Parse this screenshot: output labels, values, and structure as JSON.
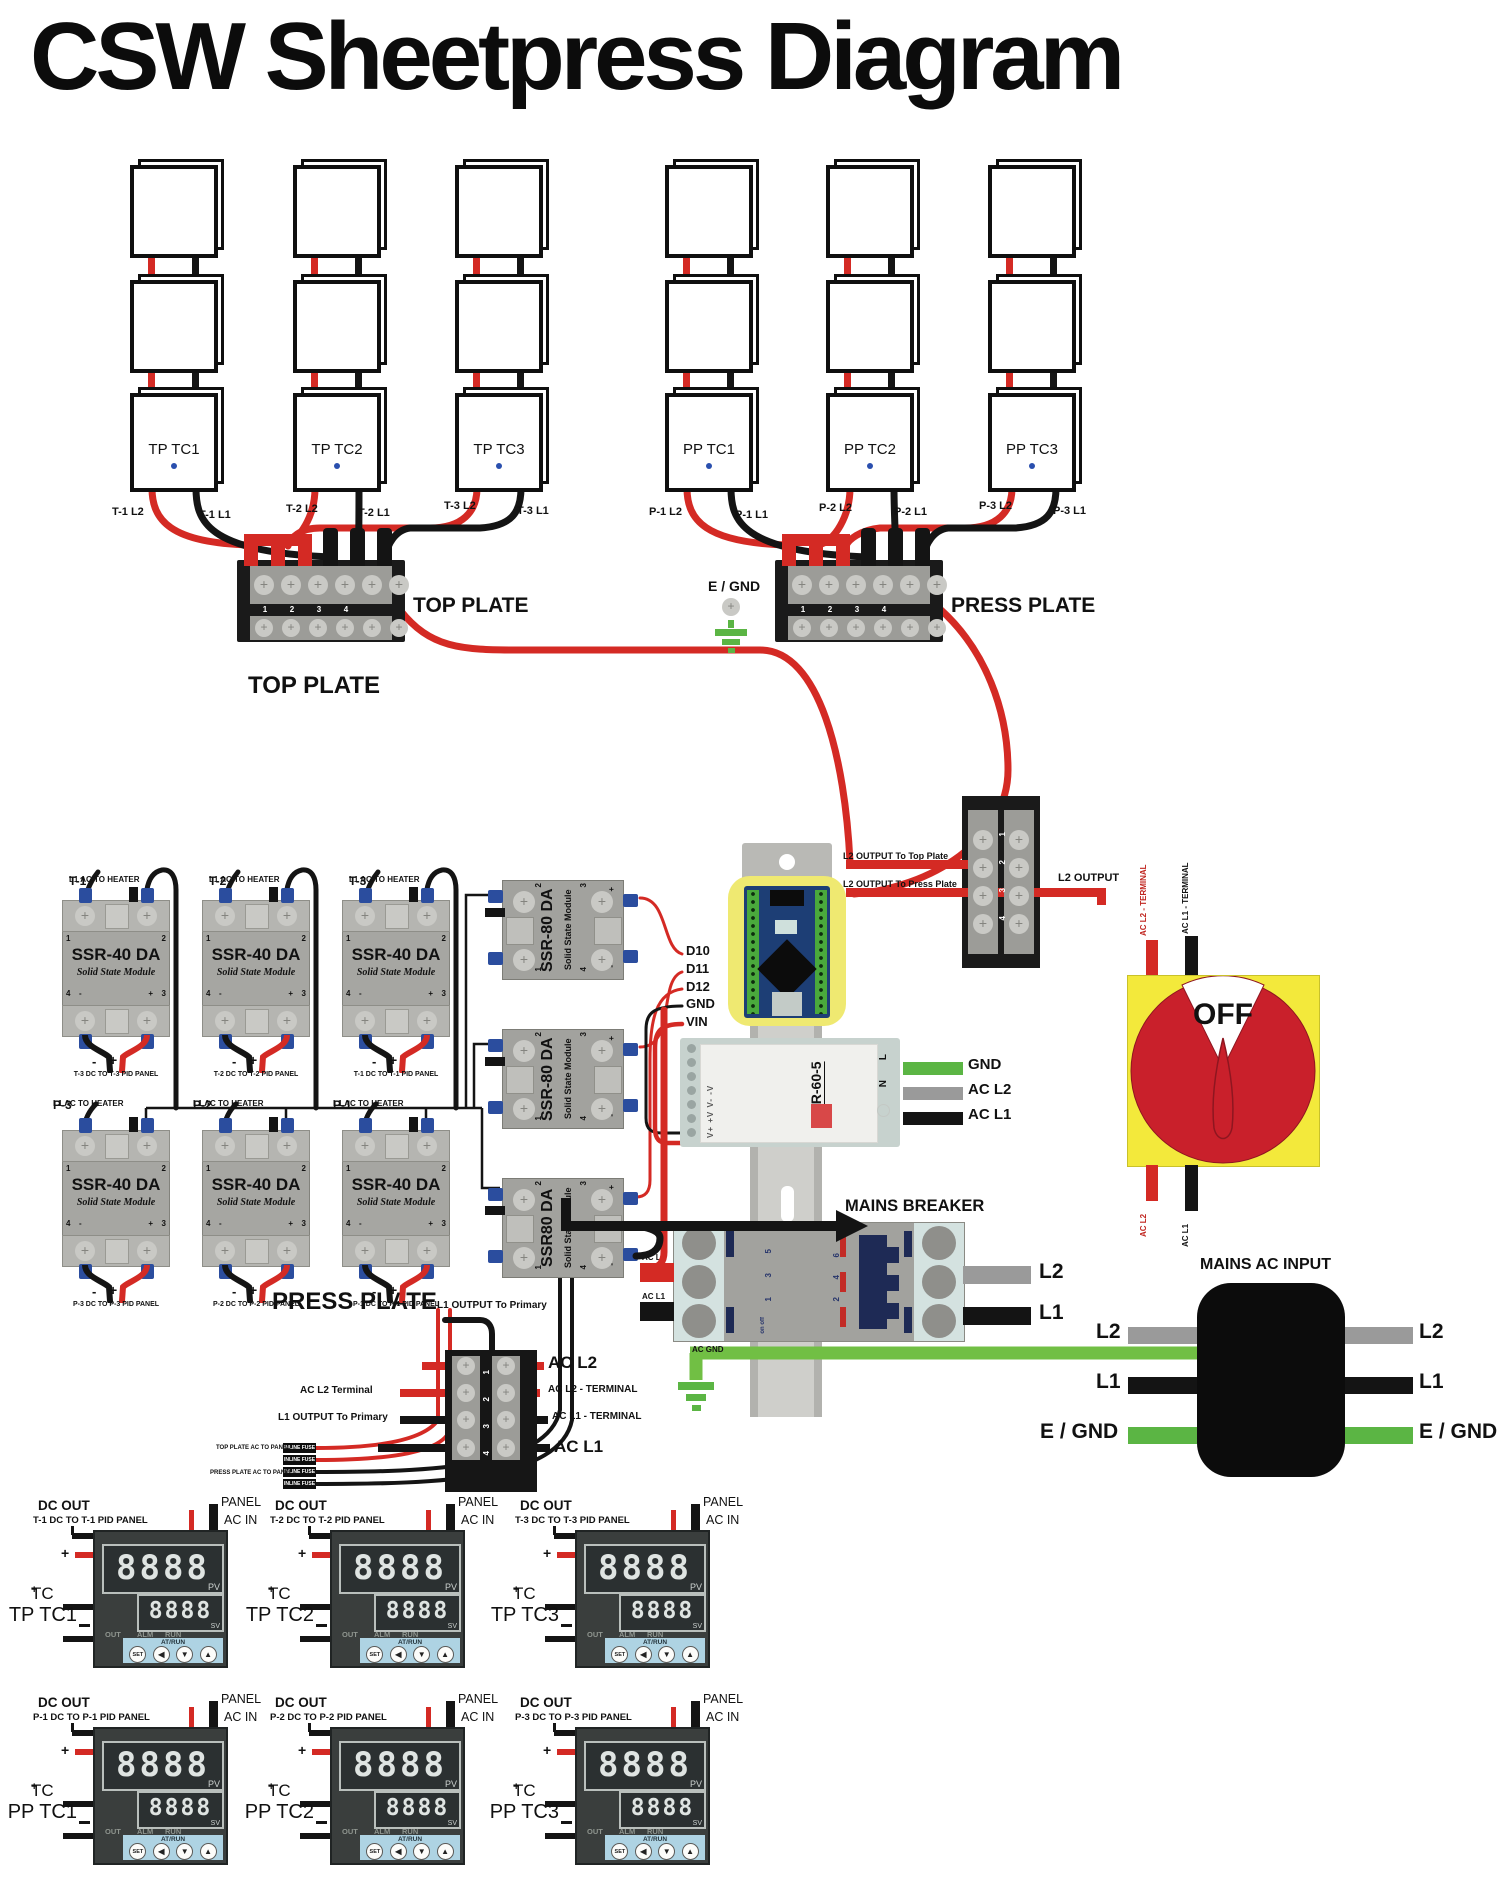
{
  "title": "CSW Sheetpress Diagram",
  "plate_groups": {
    "top": {
      "columns": [
        {
          "label": "TP TC1"
        },
        {
          "label": "TP TC2"
        },
        {
          "label": "TP TC3"
        }
      ],
      "wire_labels": [
        "T-1 L2",
        "T-1 L1",
        "T-2 L2",
        "T-2 L1",
        "T-3 L2",
        "T-3 L1"
      ],
      "terminal": {
        "label": "TOP PLATE",
        "numbers": [
          "1",
          "2",
          "3",
          "4"
        ]
      }
    },
    "press": {
      "columns": [
        {
          "label": "PP TC1"
        },
        {
          "label": "PP TC2"
        },
        {
          "label": "PP TC3"
        }
      ],
      "wire_labels": [
        "P-1 L2",
        "P-1 L1",
        "P-2 L2",
        "P-2 L1",
        "P-3 L2",
        "P-3 L1"
      ],
      "terminal": {
        "label": "PRESS PLATE",
        "numbers": [
          "1",
          "2",
          "3",
          "4"
        ]
      },
      "egnd_label": "E / GND"
    }
  },
  "ssr_section": {
    "top_plate_title": "TOP PLATE",
    "press_plate_title": "PRESS PLATE",
    "ssr40": [
      {
        "wire_id": "T-1",
        "wire_rest": "L1 AC TO HEATER",
        "name": "SSR-40 DA",
        "sub": "Solid State Module",
        "n1": "1",
        "n2": "2",
        "n3": "3",
        "n4": "4",
        "tminus": "-",
        "tplus": "+",
        "dminus": "-",
        "dplus": "+",
        "dc_label": "T-3 DC TO T-3 PID PANEL"
      },
      {
        "wire_id": "T-2",
        "wire_rest": "L1 AC TO HEATER",
        "name": "SSR-40 DA",
        "sub": "Solid State Module",
        "n1": "1",
        "n2": "2",
        "n3": "3",
        "n4": "4",
        "tminus": "-",
        "tplus": "+",
        "dminus": "-",
        "dplus": "+",
        "dc_label": "T-2 DC TO T-2 PID PANEL"
      },
      {
        "wire_id": "T-3",
        "wire_rest": "L1 AC TO HEATER",
        "name": "SSR-40 DA",
        "sub": "Solid State Module",
        "n1": "1",
        "n2": "2",
        "n3": "3",
        "n4": "4",
        "tminus": "-",
        "tplus": "+",
        "dminus": "-",
        "dplus": "+",
        "dc_label": "T-1 DC TO T-1 PID PANEL"
      },
      {
        "wire_id": "P-3",
        "wire_rest": "L1 AC TO HEATER",
        "name": "SSR-40 DA",
        "sub": "Solid State Module",
        "n1": "1",
        "n2": "2",
        "n3": "3",
        "n4": "4",
        "tminus": "-",
        "tplus": "+",
        "dminus": "-",
        "dplus": "+",
        "dc_label": "P-3 DC TO P-3 PID PANEL"
      },
      {
        "wire_id": "P-2",
        "wire_rest": "L1 AC TO HEATER",
        "name": "SSR-40 DA",
        "sub": "Solid State Module",
        "n1": "1",
        "n2": "2",
        "n3": "3",
        "n4": "4",
        "tminus": "-",
        "tplus": "+",
        "dminus": "-",
        "dplus": "+",
        "dc_label": "P-2 DC TO P-2 PID PANEL"
      },
      {
        "wire_id": "P-1",
        "wire_rest": "L1 AC TO HEATER",
        "name": "SSR-40 DA",
        "sub": "Solid State Module",
        "n1": "1",
        "n2": "2",
        "n3": "3",
        "n4": "4",
        "tminus": "-",
        "tplus": "+",
        "dminus": "-",
        "dplus": "+",
        "dc_label": "P-1 DC TO P-1 PID PANEL"
      }
    ],
    "ssr80": [
      {
        "name": "SSR-80 DA",
        "sub": "Solid State Module",
        "n1": "1",
        "n2": "2",
        "n3": "3",
        "n4": "4",
        "plus": "+",
        "minus": "-"
      },
      {
        "name": "SSR-80 DA",
        "sub": "Solid State Module",
        "n1": "1",
        "n2": "2",
        "n3": "3",
        "n4": "4",
        "plus": "+",
        "minus": "-"
      },
      {
        "name": "SSR80 DA",
        "sub": "Solid State Module",
        "n1": "1",
        "n2": "2",
        "n3": "3",
        "n4": "4",
        "plus": "+",
        "minus": "-"
      }
    ]
  },
  "arduino": {
    "pins": [
      "D10",
      "D11",
      "D12",
      "GND",
      "VIN"
    ]
  },
  "l2_output_block": {
    "numbers": [
      "1",
      "2",
      "3",
      "4"
    ],
    "to_top": "L2 OUTPUT To Top Plate",
    "to_press": "L2 OUTPUT To Press Plate",
    "output": "L2 OUTPUT"
  },
  "psu": {
    "model": "MDR-60-5",
    "terminals_left": "V+  +V  V-  -V",
    "terminal_l": "L",
    "terminal_n": "N",
    "outputs": [
      {
        "label": "GND"
      },
      {
        "label": "AC L2"
      },
      {
        "label": "AC L1"
      }
    ]
  },
  "breaker": {
    "title": "MAINS BREAKER",
    "in_l2": "AC L2",
    "in_l1": "AC L1",
    "out_l2": "L2",
    "out_l1": "L1",
    "poles_left": [
      "5",
      "3",
      "1"
    ],
    "poles_right": [
      "6",
      "4",
      "2"
    ],
    "onoff": "on off",
    "ac_gnd": "AC GND",
    "egnd": "E / GND"
  },
  "rotary_switch": {
    "state": "OFF",
    "top_l2": "AC L2 - TERMINAL",
    "top_l1": "AC L1 - TERMINAL",
    "bottom_l2": "AC L2",
    "bottom_l1": "AC L1"
  },
  "mains_input": {
    "title": "MAINS AC INPUT",
    "l2": "L2",
    "l1": "L1",
    "egnd": "E / GND"
  },
  "fuse_block": {
    "above_label": "L1 OUTPUT To Primary",
    "row1_right": "AC L2",
    "row2_left": "AC L2 Terminal",
    "row2_right": "AC L2 - TERMINAL",
    "row3_left": "L1 OUTPUT To Primary",
    "row3_right": "AC L1 - TERMINAL",
    "row4_right": "AC L1",
    "numbers": [
      "1",
      "2",
      "3",
      "4"
    ],
    "fuse_label": "INLINE FUSE",
    "left_label_top": "TOP PLATE AC TO PANEL",
    "left_label_bottom": "PRESS PLATE AC TO PANEL"
  },
  "pid": {
    "common": {
      "dc_out": "DC OUT",
      "panel": "PANEL",
      "ac_in": "AC IN",
      "plus": "+",
      "tc_plus": "+",
      "tc": "TC",
      "pv_digits": "8888",
      "sv_digits": "8888",
      "pv": "PV",
      "sv": "SV",
      "out": "OUT",
      "alm": "ALM",
      "run": "RUN",
      "atrun": "AT/RUN",
      "set": "SET",
      "left": "◀",
      "down": "▼",
      "up": "▲"
    },
    "panels": [
      {
        "route": "T-1 DC TO T-1 PID PANEL",
        "name": "TP TC1"
      },
      {
        "route": "T-2 DC TO T-2 PID PANEL",
        "name": "TP TC2"
      },
      {
        "route": "T-3 DC TO T-3 PID PANEL",
        "name": "TP TC3"
      },
      {
        "route": "P-1 DC TO P-1 PID PANEL",
        "name": "PP TC1"
      },
      {
        "route": "P-2 DC TO P-2 PID PANEL",
        "name": "PP TC2"
      },
      {
        "route": "P-3 DC TO P-3 PID PANEL",
        "name": "PP TC3"
      }
    ]
  }
}
